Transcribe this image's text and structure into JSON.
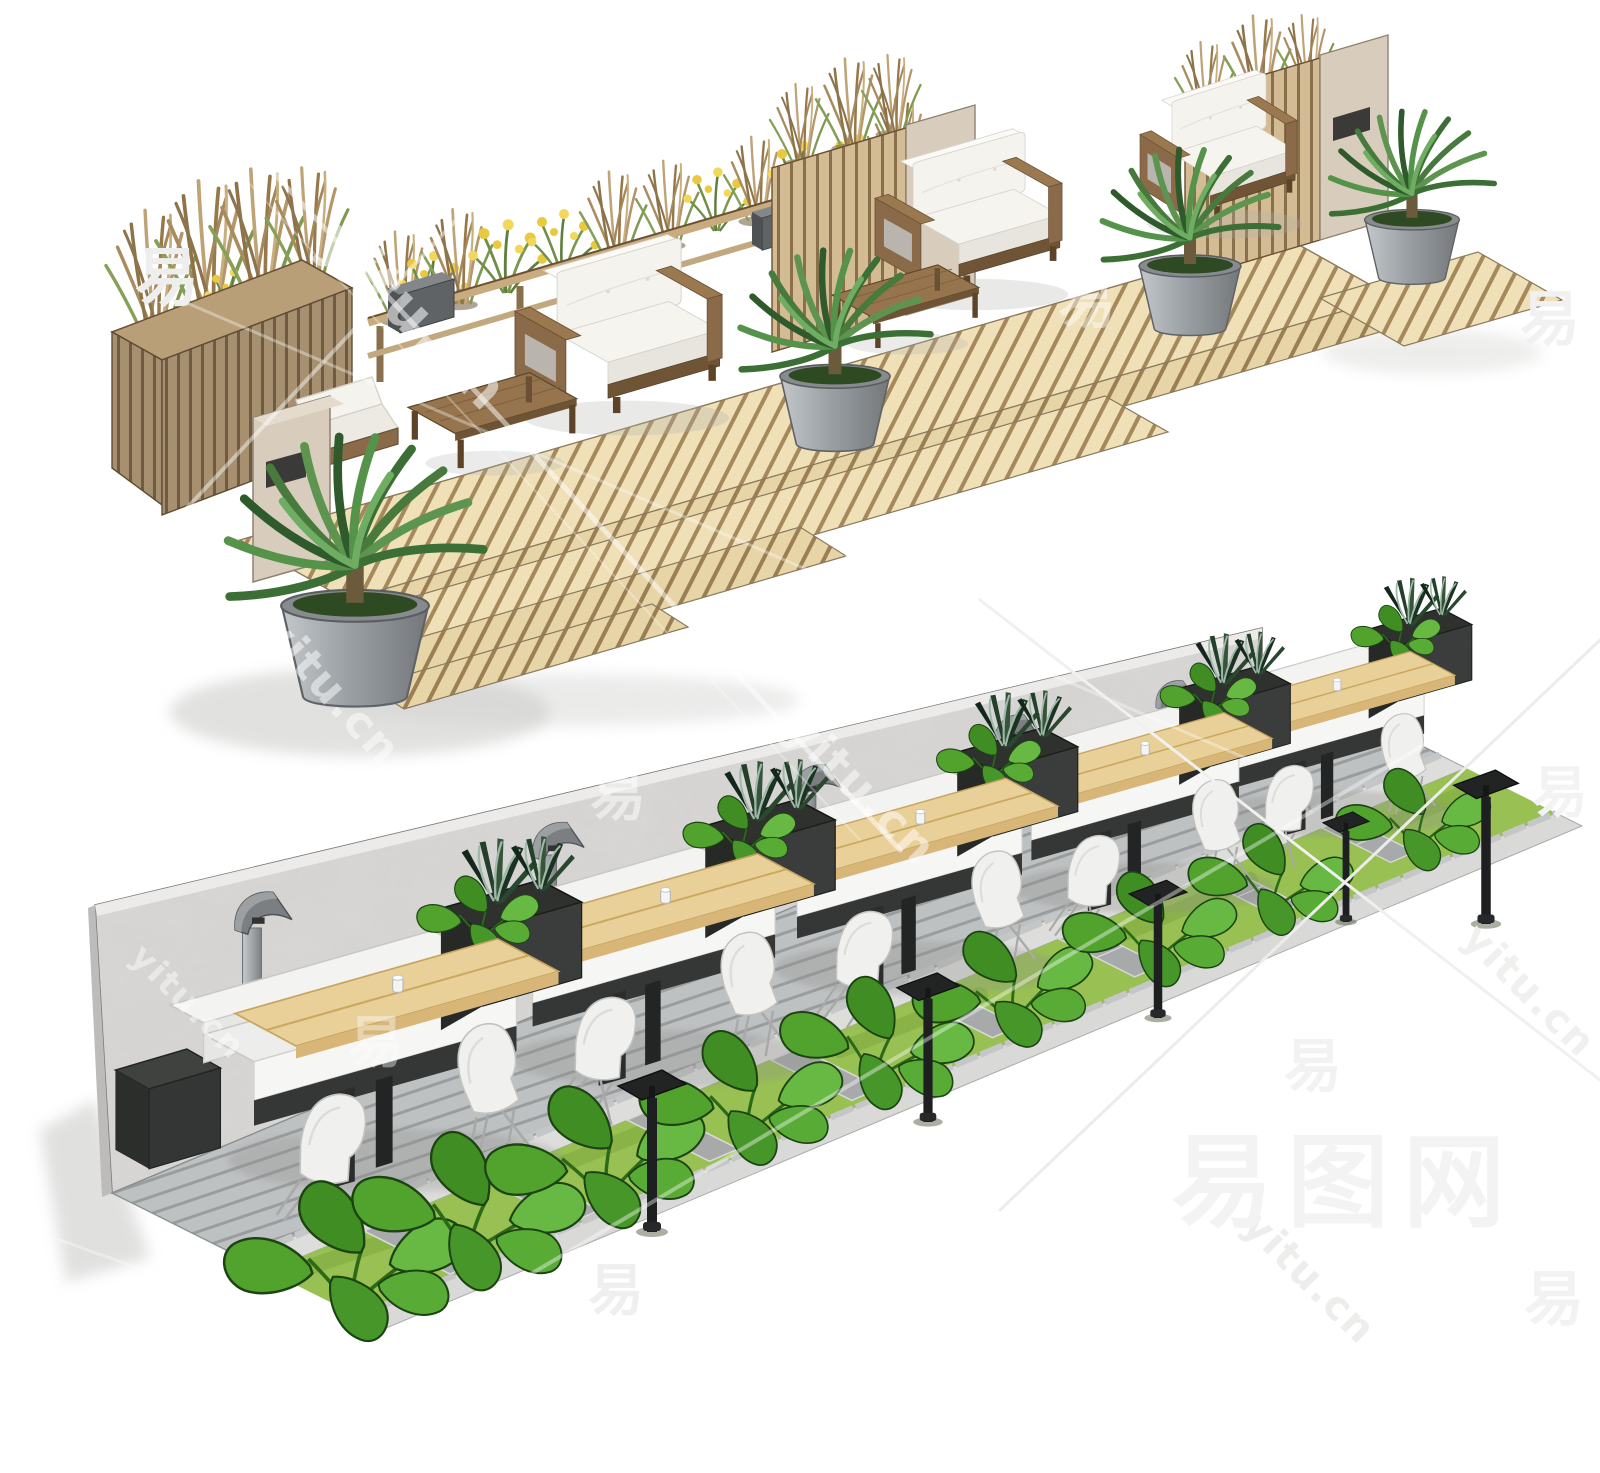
{
  "image": {
    "kind": "3d-sketchup-style-render",
    "scenes": [
      {
        "id": "scene-top-terrace",
        "description_name": "wood-deck-lounge-terrace"
      },
      {
        "id": "scene-bottom-cafe",
        "description_name": "outdoor-cafe-booth-strip"
      }
    ]
  },
  "watermarks": {
    "tile_glyph": "易",
    "site_url": "yitu.cn",
    "site_name": "易图网"
  },
  "palette": {
    "deck_wood": "#ecd9ad",
    "deck_gap": "#a5885c",
    "wood_frame": "#8a6a48",
    "wood_dark": "#6b5133",
    "table_wood": "#96754e",
    "cushion": "#f5f3ee",
    "cushion_shade": "#e8e5de",
    "stucco": "#d8cdbc",
    "slat_light": "#cbb28a",
    "slat_dark": "#8a6f4c",
    "dry_grass": "#a98c5e",
    "olive": "#7f9a50",
    "flower_yellow": "#e8c93f",
    "palm_green": "#477a3c",
    "pot_light": "#b9bdc0",
    "pot_dark": "#7e8285",
    "wall_concrete": "#d8d7d5",
    "booth_white": "#f3f3f1",
    "booth_shade": "#e6e6e4",
    "charcoal": "#343735",
    "planter_dark": "#2f312f",
    "maple": "#e9d099",
    "maple_edge": "#d7b678",
    "path_gray": "#b9bcbd",
    "paver_gray": "#a7a9ab",
    "curb_light": "#dddddc",
    "lawn_green": "#98c052",
    "monstera_green": "#4f9e30",
    "lamp_gray": "#9b9fa2",
    "fixture_black": "#1d1f20",
    "shadow_gray": "#c9c9c7",
    "watermark_gray": "#f2f2f2"
  }
}
